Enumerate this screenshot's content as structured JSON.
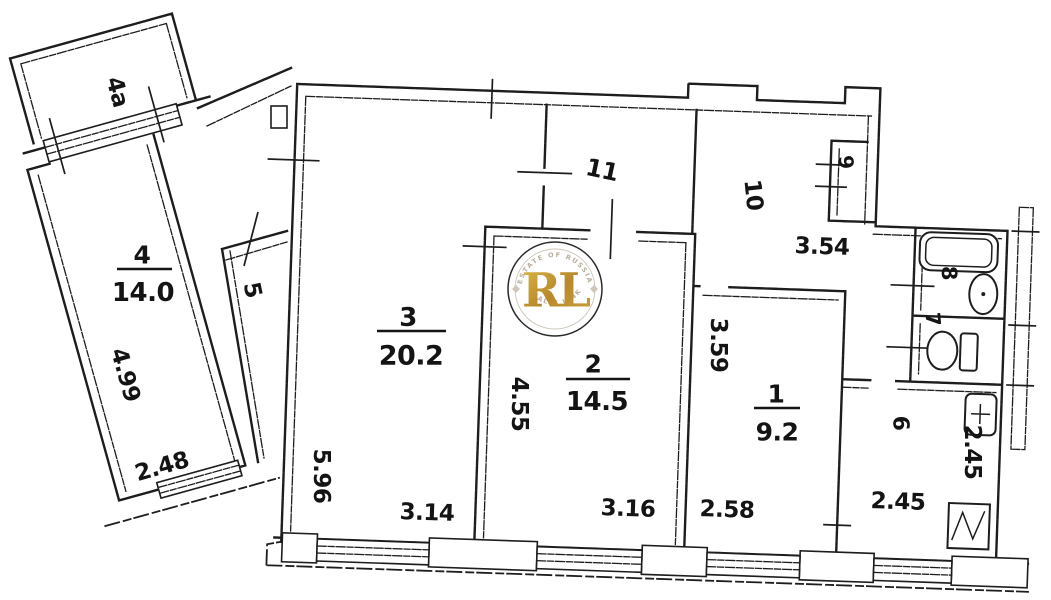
{
  "rooms": {
    "r1": {
      "number": "1",
      "area": "9.2"
    },
    "r2": {
      "number": "2",
      "area": "14.5"
    },
    "r3": {
      "number": "3",
      "area": "20.2"
    },
    "r4": {
      "number": "4",
      "area": "14.0"
    },
    "r4a": {
      "number": "4a"
    },
    "r5": {
      "number": "5"
    },
    "r6": {
      "number": "6"
    },
    "r7": {
      "number": "7"
    },
    "r8": {
      "number": "8"
    },
    "r9": {
      "number": "9"
    },
    "r10": {
      "number": "10"
    },
    "r11": {
      "number": "11"
    }
  },
  "dimensions": {
    "room1_width": "2.58",
    "room1_depth": "3.59",
    "room2_width": "3.16",
    "room2_depth": "4.55",
    "room3_width": "3.14",
    "room3_depth": "5.96",
    "room4_width": "2.48",
    "room4_depth": "4.99",
    "room6_width": "2.45",
    "room6_depth": "2.45",
    "hallway_width": "3.54"
  },
  "fixtures": {
    "bathtub": "bathtub-icon",
    "washbasin": "washbasin-icon",
    "toilet": "toilet-icon",
    "kitchen_sink": "kitchen-sink-icon",
    "stove": "stove-icon"
  },
  "watermark": {
    "monogram": "RL",
    "arc_top": "ESTATE OF RUSSIA",
    "arc_bottom": "REALTY LINK",
    "gold_color": "#c49a2c",
    "ring_color": "#2b2b2b"
  },
  "colors": {
    "wall_ink": "#1d1d1d",
    "background": "#ffffff"
  }
}
